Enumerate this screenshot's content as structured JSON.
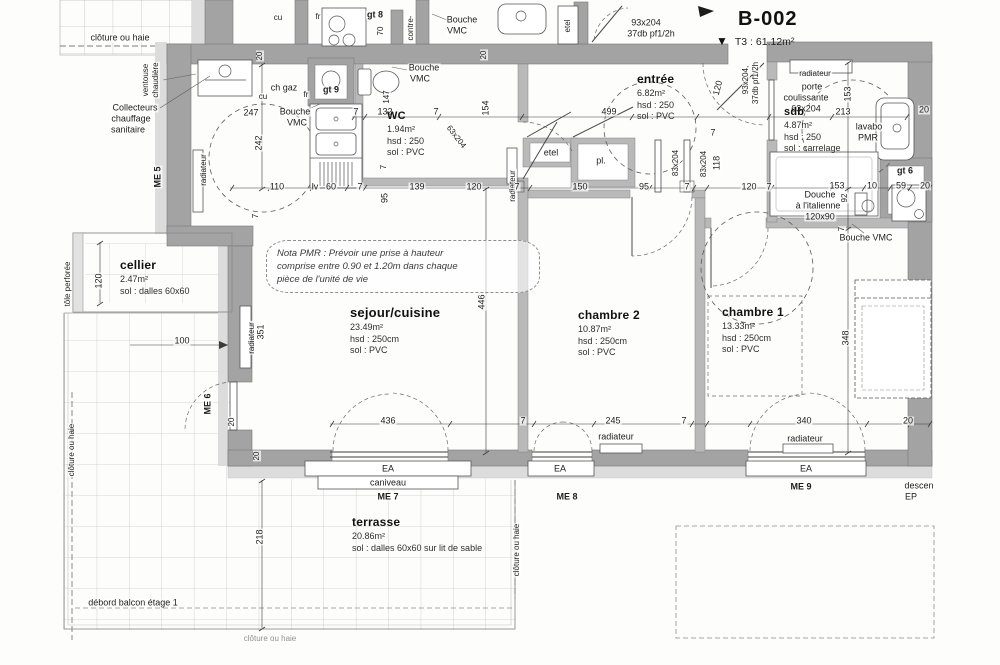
{
  "header": {
    "unit_code": "B-002",
    "marker": "▼",
    "unit_type": "T3 : 61.12m²"
  },
  "rooms": [
    {
      "id": "sejour-cuisine",
      "title": "sejour/cuisine",
      "fs": 13,
      "x": 350,
      "y": 305,
      "lines": [
        "23.49m²",
        "hsd : 250cm",
        "sol : PVC"
      ]
    },
    {
      "id": "chambre-2",
      "title": "chambre 2",
      "fs": 12,
      "x": 578,
      "y": 308,
      "lines": [
        "10.87m²",
        "hsd : 250cm",
        "sol : PVC"
      ]
    },
    {
      "id": "chambre-1",
      "title": "chambre 1",
      "fs": 12,
      "x": 722,
      "y": 305,
      "lines": [
        "13.33m²",
        "hsd : 250cm",
        "sol : PVC"
      ]
    },
    {
      "id": "entree",
      "title": "entrée",
      "fs": 12,
      "x": 637,
      "y": 72,
      "lines": [
        "6.82m²",
        "hsd : 250",
        "sol : PVC"
      ]
    },
    {
      "id": "wc",
      "title": "WC",
      "fs": 11,
      "x": 387,
      "y": 110,
      "lines": [
        "1.94m²",
        "hsd : 250",
        "sol : PVC"
      ]
    },
    {
      "id": "sdb",
      "title": "sdb",
      "fs": 11,
      "x": 784,
      "y": 106,
      "lines": [
        "4.87m²",
        "hsd : 250",
        "sol : carrelage"
      ]
    },
    {
      "id": "cellier",
      "title": "cellier",
      "fs": 12,
      "x": 120,
      "y": 258,
      "lines": [
        "2.47m²",
        "sol : dalles 60x60"
      ]
    },
    {
      "id": "terrasse",
      "title": "terrasse",
      "fs": 12,
      "x": 352,
      "y": 515,
      "lines": [
        "20.86m²",
        "sol : dalles 60x60 sur lit de sable"
      ]
    }
  ],
  "nota_pmr": {
    "lines": [
      "Nota PMR : Prévoir une prise à hauteur",
      "comprise entre 0.90 et 1.20m dans chaque",
      "pièce de l'unité de vie"
    ]
  },
  "labels": [
    {
      "t": "clôture ou haie",
      "x": 120,
      "y": 38
    },
    {
      "t": "cu",
      "x": 278,
      "y": 18,
      "fs": 8
    },
    {
      "t": "fr",
      "x": 318,
      "y": 17,
      "fs": 8
    },
    {
      "t": "gt 8",
      "x": 375,
      "y": 15,
      "b": 1
    },
    {
      "t": "70",
      "x": 381,
      "y": 31,
      "r": -90,
      "fs": 8
    },
    {
      "t": "contre-",
      "x": 411,
      "y": 28,
      "r": -90,
      "fs": 8
    },
    {
      "t": "Bouche",
      "x": 462,
      "y": 20
    },
    {
      "t": "VMC",
      "x": 457,
      "y": 31
    },
    {
      "t": "etel",
      "x": 568,
      "y": 26,
      "r": -90,
      "fs": 8
    },
    {
      "t": "93x204",
      "x": 646,
      "y": 23
    },
    {
      "t": "37db pf1/2h",
      "x": 651,
      "y": 34
    },
    {
      "t": "20",
      "x": 260,
      "y": 56,
      "r": -90,
      "fs": 8
    },
    {
      "t": "20",
      "x": 484,
      "y": 55,
      "r": -90,
      "fs": 8
    },
    {
      "t": "ventouse",
      "x": 146,
      "y": 80,
      "r": -90,
      "fs": 8
    },
    {
      "t": "chaudière",
      "x": 156,
      "y": 80,
      "r": -90,
      "fs": 8
    },
    {
      "t": "Collecteurs",
      "x": 135,
      "y": 108
    },
    {
      "t": "chauffage",
      "x": 131,
      "y": 119
    },
    {
      "t": "sanitaire",
      "x": 128,
      "y": 130
    },
    {
      "t": "ME 5",
      "x": 158,
      "y": 177,
      "r": -90,
      "b": 1
    },
    {
      "t": "radiateur",
      "x": 204,
      "y": 170,
      "r": -90,
      "fs": 8
    },
    {
      "t": "ch gaz",
      "x": 284,
      "y": 88
    },
    {
      "t": "247",
      "x": 251,
      "y": 113
    },
    {
      "t": "Bouche",
      "x": 295,
      "y": 112
    },
    {
      "t": "VMC",
      "x": 297,
      "y": 123
    },
    {
      "t": "gt 9",
      "x": 331,
      "y": 90,
      "b": 1
    },
    {
      "t": "fr",
      "x": 306,
      "y": 95,
      "fs": 8
    },
    {
      "t": "cu",
      "x": 263,
      "y": 97,
      "fs": 8
    },
    {
      "t": "242",
      "x": 259,
      "y": 143,
      "r": -90
    },
    {
      "t": "110",
      "x": 277,
      "y": 187
    },
    {
      "t": "lv",
      "x": 315,
      "y": 187
    },
    {
      "t": "60",
      "x": 331,
      "y": 187
    },
    {
      "t": "7",
      "x": 360,
      "y": 187
    },
    {
      "t": "139",
      "x": 417,
      "y": 187
    },
    {
      "t": "120",
      "x": 474,
      "y": 187
    },
    {
      "t": "95",
      "x": 385,
      "y": 198,
      "r": -90
    },
    {
      "t": "7",
      "x": 384,
      "y": 167,
      "r": -90,
      "fs": 8
    },
    {
      "t": "7",
      "x": 256,
      "y": 216,
      "r": -90,
      "fs": 8
    },
    {
      "t": "Bouche",
      "x": 424,
      "y": 68
    },
    {
      "t": "VMC",
      "x": 420,
      "y": 79
    },
    {
      "t": "147",
      "x": 387,
      "y": 97,
      "r": -90,
      "fs": 8
    },
    {
      "t": "7",
      "x": 356,
      "y": 112
    },
    {
      "t": "132",
      "x": 385,
      "y": 112
    },
    {
      "t": "7",
      "x": 436,
      "y": 112
    },
    {
      "t": "154",
      "x": 486,
      "y": 108,
      "r": -90
    },
    {
      "t": "63x204",
      "x": 456,
      "y": 137,
      "r": 52,
      "fs": 8
    },
    {
      "t": "radiateur",
      "x": 513,
      "y": 186,
      "r": -90,
      "fs": 8
    },
    {
      "t": "499",
      "x": 609,
      "y": 112
    },
    {
      "t": "etel",
      "x": 551,
      "y": 153
    },
    {
      "t": "pl.",
      "x": 601,
      "y": 161
    },
    {
      "t": "7",
      "x": 517,
      "y": 187
    },
    {
      "t": "150",
      "x": 580,
      "y": 187
    },
    {
      "t": "95",
      "x": 644,
      "y": 187
    },
    {
      "t": "7",
      "x": 687,
      "y": 187
    },
    {
      "t": "120",
      "x": 749,
      "y": 187
    },
    {
      "t": "7",
      "x": 769,
      "y": 187
    },
    {
      "t": "83x204",
      "x": 676,
      "y": 163,
      "r": -90,
      "fs": 8
    },
    {
      "t": "83x204",
      "x": 704,
      "y": 164,
      "r": -90,
      "fs": 8
    },
    {
      "t": "118",
      "x": 717,
      "y": 163,
      "r": -90
    },
    {
      "t": "93x204,",
      "x": 746,
      "y": 80,
      "r": -90,
      "fs": 8
    },
    {
      "t": "37db pf1/2h",
      "x": 756,
      "y": 83,
      "r": -90,
      "fs": 8
    },
    {
      "t": "120",
      "x": 718,
      "y": 88,
      "r": -75
    },
    {
      "t": "7",
      "x": 713,
      "y": 133
    },
    {
      "t": "radiateur",
      "x": 815,
      "y": 74,
      "fs": 8
    },
    {
      "t": "porte",
      "x": 812,
      "y": 87
    },
    {
      "t": "coulissante",
      "x": 806,
      "y": 98
    },
    {
      "t": "63x204",
      "x": 806,
      "y": 109
    },
    {
      "t": "213",
      "x": 843,
      "y": 112
    },
    {
      "t": "153",
      "x": 848,
      "y": 94,
      "r": -90
    },
    {
      "t": "lavabo",
      "x": 869,
      "y": 127
    },
    {
      "t": "PMR",
      "x": 868,
      "y": 138
    },
    {
      "t": "20",
      "x": 924,
      "y": 110
    },
    {
      "t": "153",
      "x": 837,
      "y": 186
    },
    {
      "t": "10",
      "x": 872,
      "y": 186
    },
    {
      "t": "59",
      "x": 901,
      "y": 186
    },
    {
      "t": "20",
      "x": 925,
      "y": 186
    },
    {
      "t": "Douche",
      "x": 820,
      "y": 195
    },
    {
      "t": "à l'italienne",
      "x": 818,
      "y": 206
    },
    {
      "t": "120x90",
      "x": 820,
      "y": 217
    },
    {
      "t": "92",
      "x": 845,
      "y": 198,
      "r": -90,
      "fs": 8
    },
    {
      "t": "gt 6",
      "x": 905,
      "y": 171,
      "b": 1
    },
    {
      "t": "7",
      "x": 842,
      "y": 229,
      "r": -90,
      "fs": 8
    },
    {
      "t": "Bouche VMC",
      "x": 866,
      "y": 238
    },
    {
      "t": "446",
      "x": 482,
      "y": 302,
      "r": -90
    },
    {
      "t": "348",
      "x": 846,
      "y": 338,
      "r": -90
    },
    {
      "t": "radiateur",
      "x": 252,
      "y": 338,
      "r": -90,
      "fs": 8
    },
    {
      "t": "351",
      "x": 261,
      "y": 332,
      "r": -90
    },
    {
      "t": "100",
      "x": 182,
      "y": 341
    },
    {
      "t": "120",
      "x": 99,
      "y": 281,
      "r": -90
    },
    {
      "t": "tôle perforée",
      "x": 68,
      "y": 284,
      "r": -90,
      "fs": 8
    },
    {
      "t": "ME 6",
      "x": 208,
      "y": 404,
      "r": -90,
      "b": 1
    },
    {
      "t": "436",
      "x": 388,
      "y": 421
    },
    {
      "t": "7",
      "x": 523,
      "y": 421
    },
    {
      "t": "245",
      "x": 613,
      "y": 421
    },
    {
      "t": "7",
      "x": 684,
      "y": 421
    },
    {
      "t": "340",
      "x": 804,
      "y": 421
    },
    {
      "t": "20",
      "x": 908,
      "y": 421
    },
    {
      "t": "radiateur",
      "x": 616,
      "y": 437
    },
    {
      "t": "radiateur",
      "x": 805,
      "y": 439
    },
    {
      "t": "20",
      "x": 232,
      "y": 422,
      "r": -90,
      "fs": 8
    },
    {
      "t": "20",
      "x": 257,
      "y": 456,
      "r": -90,
      "fs": 8
    },
    {
      "t": "EA",
      "x": 388,
      "y": 469
    },
    {
      "t": "caniveau",
      "x": 388,
      "y": 483
    },
    {
      "t": "ME 7",
      "x": 388,
      "y": 497,
      "b": 1
    },
    {
      "t": "EA",
      "x": 560,
      "y": 469
    },
    {
      "t": "ME 8",
      "x": 567,
      "y": 497,
      "b": 1
    },
    {
      "t": "EA",
      "x": 806,
      "y": 469
    },
    {
      "t": "ME 9",
      "x": 801,
      "y": 487,
      "b": 1
    },
    {
      "t": "descen",
      "x": 919,
      "y": 486
    },
    {
      "t": "EP",
      "x": 911,
      "y": 497
    },
    {
      "t": "218",
      "x": 260,
      "y": 537,
      "r": -90
    },
    {
      "t": "clôture ou haie",
      "x": 72,
      "y": 450,
      "r": -90,
      "fs": 8
    },
    {
      "t": "clôture ou haie",
      "x": 517,
      "y": 550,
      "r": -90,
      "fs": 8
    },
    {
      "t": "débord balcon étage 1",
      "x": 133,
      "y": 603
    },
    {
      "t": "clôture ou haie",
      "x": 270,
      "y": 639,
      "fs": 8,
      "c": "#8f8f8f"
    }
  ]
}
